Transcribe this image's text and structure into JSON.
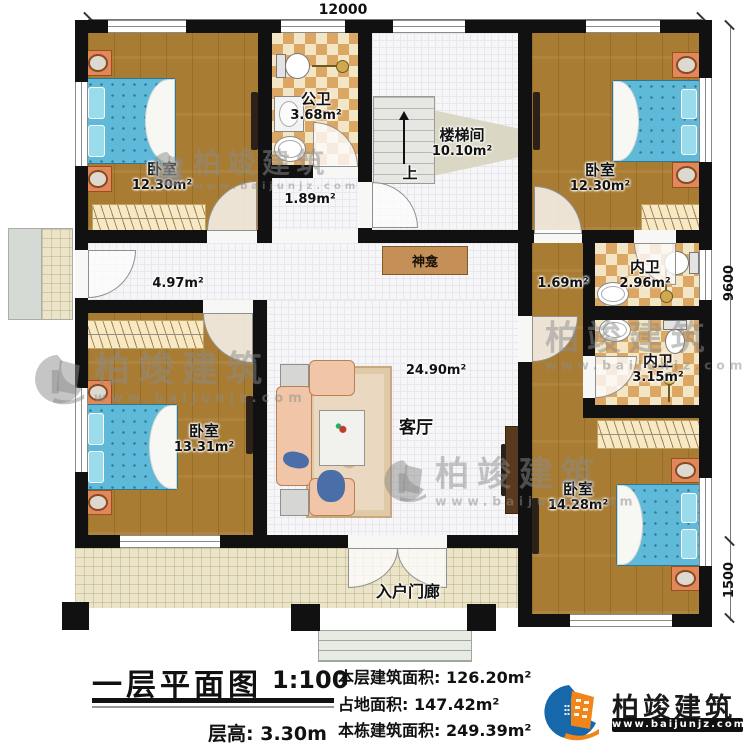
{
  "dims": {
    "top": "12000",
    "right_main": "9600",
    "right_porch": "1500"
  },
  "rooms": {
    "bedroom_tl": {
      "name": "卧室",
      "area": "12.30m²"
    },
    "public_bath": {
      "name": "公卫",
      "area": "3.68m²"
    },
    "lobby": {
      "area": "1.89m²"
    },
    "stairwell": {
      "name": "楼梯间",
      "area": "10.10m²",
      "up_label": "上"
    },
    "bedroom_tr": {
      "name": "卧室",
      "area": "12.30m²"
    },
    "corridor": {
      "area": "4.97m²"
    },
    "shrine": {
      "name": "神龛"
    },
    "junction": {
      "area": "1.69m²"
    },
    "ensuite_top": {
      "name": "内卫",
      "area": "2.96m²"
    },
    "ensuite_bottom": {
      "name": "内卫",
      "area": "3.15m²"
    },
    "living": {
      "name": "客厅",
      "area": "24.90m²"
    },
    "bedroom_bl": {
      "name": "卧室",
      "area": "13.31m²"
    },
    "bedroom_br": {
      "name": "卧室",
      "area": "14.28m²"
    },
    "porch": {
      "name": "入户门廊"
    }
  },
  "title_block": {
    "title": "一层平面图",
    "scale": "1:100",
    "floor_height_label": "层高:",
    "floor_height_value": "3.30m",
    "stats": [
      {
        "label": "本层建筑面积:",
        "value": "126.20m²"
      },
      {
        "label": "占地面积:",
        "value": "147.42m²"
      },
      {
        "label": "本栋建筑面积:",
        "value": "249.39m²"
      }
    ]
  },
  "branding": {
    "name": "柏竣建筑",
    "website": "www.baijunjz.com"
  },
  "watermark": {
    "name": "柏竣建筑",
    "website": "www.baijunjz.com"
  },
  "colors": {
    "wall": "#111111",
    "wood": "#a97c33",
    "tile_cream": "#f3e6c6",
    "tile_tan": "#dca763",
    "bed_blue": "#5fb9d8",
    "accent_blue": "#1767ab",
    "accent_orange": "#f08519"
  }
}
